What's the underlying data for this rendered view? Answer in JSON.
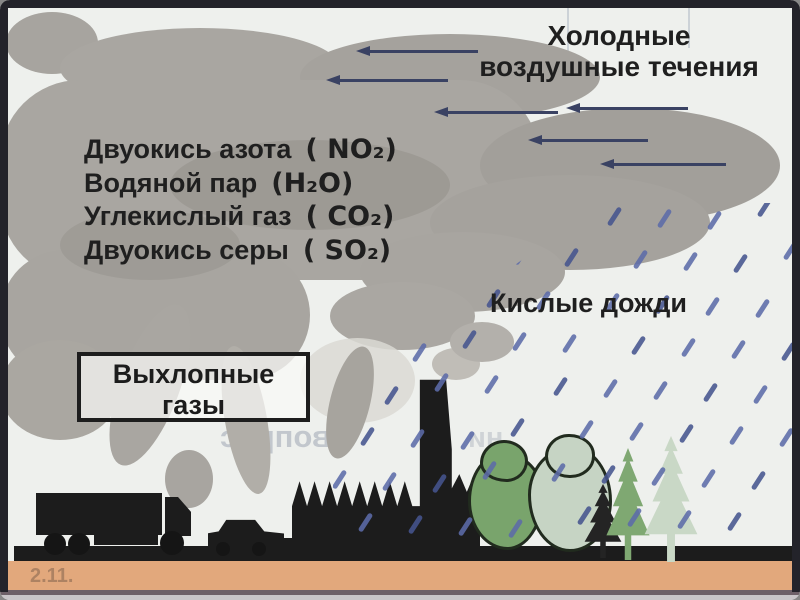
{
  "title": {
    "line1": "Холодные",
    "line2": "воздушные течения",
    "arrow_count": 6
  },
  "pollutants": [
    {
      "name": "Двуокись азота",
      "formula": "( NO₂)"
    },
    {
      "name": "Водяной пар",
      "formula": "(H₂O)"
    },
    {
      "name": "Углекислый газ",
      "formula": "( CO₂)"
    },
    {
      "name": "Двуокись серы",
      "formula": "( SO₂)"
    }
  ],
  "acid_rain_label": "Кислые дожди",
  "exhaust_box": {
    "line1": "Выхлопные",
    "line2": "газы"
  },
  "bleed_through": {
    "left_fragment": "копи",
    "mirrored_fragment": "вопрос",
    "mirrored_fragment2": "ни",
    "bottom_fragment": "2.11."
  },
  "icons": {
    "cloud": "smoke-cloud",
    "arrows": "left-arrow",
    "rain": "diagonal-rain-dashes",
    "truck": "truck-silhouette",
    "car": "car-silhouette",
    "factory": "factory-with-chimney-silhouette",
    "trees": [
      "deciduous-tree",
      "deciduous-tree-pale",
      "fir-tree",
      "fir-tree-pale"
    ]
  },
  "colors": {
    "cloud": "#a9a6a1",
    "arrow": "#3a4263",
    "rain": "#5c6ba8",
    "ground": "#1b1b1b",
    "bottom_strip": "#e2a87c",
    "tree_green": "#79a46c",
    "tree_pale": "#c6d4c4",
    "fir_green": "#7fa872",
    "fir_pale": "#c9d8c6",
    "silhouette": "#1c1c1c",
    "text": "#1f1f1f"
  }
}
